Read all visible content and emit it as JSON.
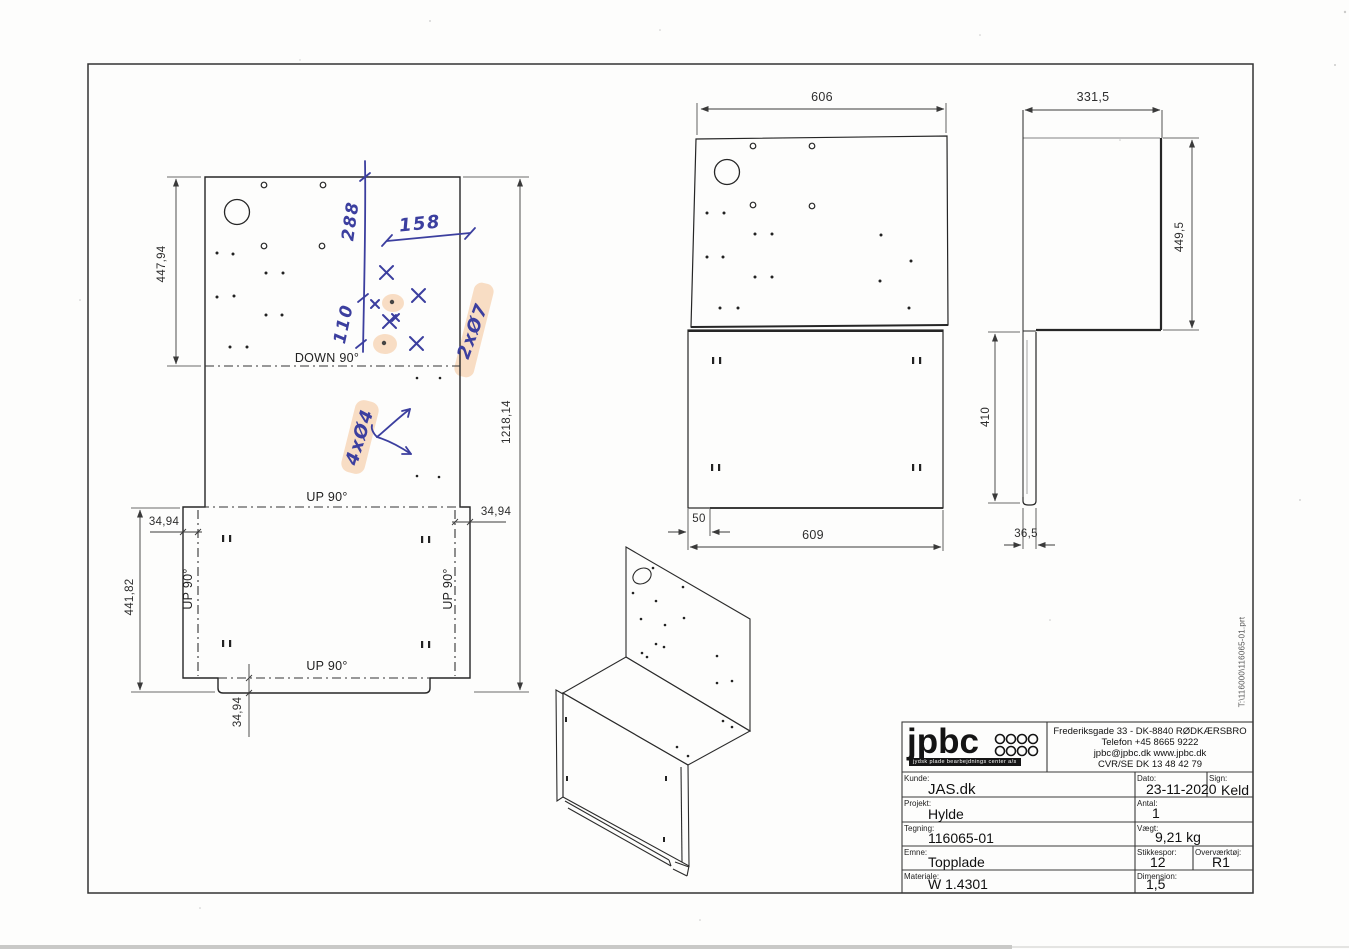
{
  "drawing": {
    "flat_view": {
      "dim_top_section_height": "447,94",
      "dim_total_length": "1218,14",
      "dim_bottom_section_height": "441,82",
      "dim_flange_left": "34,94",
      "dim_flange_right": "34,94",
      "dim_bottom_tab": "34,94",
      "fold_down": "DOWN 90°",
      "fold_up_top": "UP 90°",
      "fold_up_left": "UP 90°",
      "fold_up_right": "UP 90°",
      "fold_up_bottom": "UP 90°"
    },
    "handwritten_notes": {
      "dim_288": "288",
      "dim_158": "158",
      "dim_110": "110",
      "holes_note_1": "2xØ7",
      "holes_note_2": "4xØ4",
      "ink_color": "#3c3f9f",
      "highlight_color": "#f6c9a0"
    },
    "front_view": {
      "dim_width_top": "606",
      "dim_width_bottom": "609",
      "dim_step": "50"
    },
    "side_view": {
      "dim_depth": "331,5",
      "dim_height": "449,5",
      "dim_leg_length": "410",
      "dim_leg_width": "36,5"
    },
    "file_path_note": "T:\\116000\\116065-01.prt"
  },
  "title_block": {
    "logo": {
      "text": "jpbc",
      "subtext": "jydsk plade bearbejdnings center a/s"
    },
    "company": {
      "address": "Frederiksgade 33 - DK-8840 RØDKÆRSBRO",
      "phone": "Telefon +45 8665 9222",
      "email_web": "jpbc@jpbc.dk      www.jpbc.dk",
      "cvr": "CVR/SE DK 13 48 42 79"
    },
    "fields": {
      "kunde": {
        "label": "Kunde:",
        "value": "JAS.dk"
      },
      "projekt": {
        "label": "Projekt:",
        "value": "Hylde"
      },
      "tegning": {
        "label": "Tegning:",
        "value": "116065-01"
      },
      "emne": {
        "label": "Emne:",
        "value": "Topplade"
      },
      "materiale": {
        "label": "Materiale:",
        "value": "W 1.4301"
      },
      "dato": {
        "label": "Dato:",
        "value": "23-11-2020"
      },
      "sign": {
        "label": "Sign:",
        "value": "Keld"
      },
      "antal": {
        "label": "Antal:",
        "value": "1"
      },
      "vaegt": {
        "label": "Vægt:",
        "value": "9,21 kg"
      },
      "stikkespor": {
        "label": "Stikkespor:",
        "value": "12"
      },
      "overvaerktoj": {
        "label": "Overværktøj:",
        "value": "R1"
      },
      "dimension": {
        "label": "Dimension:",
        "value": "1,5"
      }
    }
  }
}
